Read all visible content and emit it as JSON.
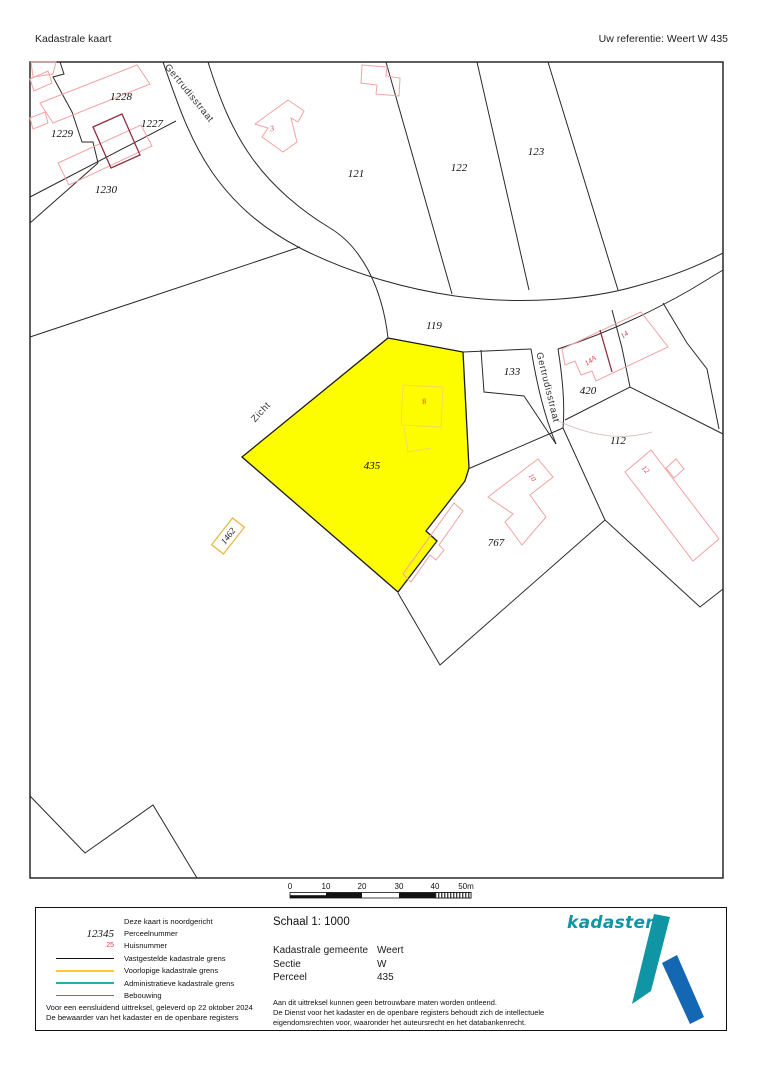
{
  "header": {
    "title": "Kadastrale kaart",
    "reference": "Uw referentie: Weert W 435"
  },
  "map": {
    "highlighted_parcel": "435",
    "streets": [
      {
        "name": "Gertrudisstraat"
      },
      {
        "name": "Gertrudisstraat"
      },
      {
        "name": "Zicht"
      }
    ],
    "parcels": [
      {
        "number": "1228"
      },
      {
        "number": "1229"
      },
      {
        "number": "1227"
      },
      {
        "number": "1230"
      },
      {
        "number": "121"
      },
      {
        "number": "122"
      },
      {
        "number": "123"
      },
      {
        "number": "119"
      },
      {
        "number": "133"
      },
      {
        "number": "420"
      },
      {
        "number": "112"
      },
      {
        "number": "435"
      },
      {
        "number": "767"
      }
    ],
    "house_numbers": [
      {
        "number": "3"
      },
      {
        "number": "8"
      },
      {
        "number": "14A"
      },
      {
        "number": "14"
      },
      {
        "number": "10"
      },
      {
        "number": "12"
      }
    ],
    "provisional_parcel": {
      "number": "1462"
    },
    "scalebar": {
      "ticks": [
        "0",
        "10",
        "20",
        "30",
        "40",
        "50m"
      ]
    }
  },
  "panel": {
    "schaal": "Schaal 1: 1000",
    "details": [
      {
        "label": "Kadastrale gemeente",
        "value": "Weert"
      },
      {
        "label": "Sectie",
        "value": "W"
      },
      {
        "label": "Perceel",
        "value": "435"
      }
    ],
    "disclaimer": [
      "Aan dit uittreksel kunnen geen betrouwbare maten worden ontleend.",
      "De Dienst voor het kadaster en de openbare registers behoudt zich de intellectuele",
      "eigendomsrechten voor, waaronder het auteursrecht en het databankenrecht."
    ],
    "legend": {
      "north_note": "Deze kaart is noordgericht",
      "items": [
        {
          "symbol": "12345",
          "label": "Perceelnummer"
        },
        {
          "symbol": "25",
          "label": "Huisnummer"
        },
        {
          "symbol": "line-black",
          "label": "Vastgestelde kadastrale grens"
        },
        {
          "symbol": "line-yellow",
          "label": "Voorlopige kadastrale grens"
        },
        {
          "symbol": "line-teal",
          "label": "Administratieve kadastrale grens"
        },
        {
          "symbol": "line-red",
          "label": "Bebouwing"
        }
      ]
    },
    "attestation": [
      "Voor een eensluidend uittreksel, geleverd op 22 oktober 2024",
      "De bewaarder van het kadaster en de openbare registers"
    ],
    "logo_text": "kadaster"
  },
  "colors": {
    "highlight_yellow": "#fdfd00",
    "building_pink": "#f2a3a3",
    "building_dark_red": "#8e2f3f",
    "house_number_red": "#d9404a",
    "provisional_yellow": "#eab440",
    "admin_teal": "#1ab3b3",
    "legend_yellow": "#ffc832",
    "legend_red": "#e04848",
    "logo_teal": "#1095a5",
    "logo_blue": "#1467b3",
    "boundary_black": "#2a2a2a"
  }
}
